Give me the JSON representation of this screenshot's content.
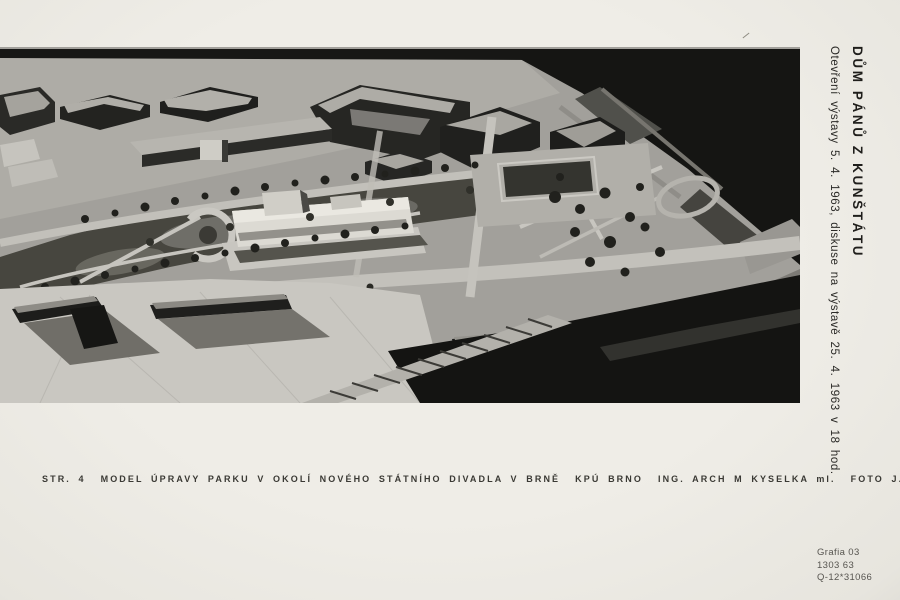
{
  "document": {
    "spine": {
      "title": "DŮM PÁNŮ Z KUNŠTÁTU",
      "subtitle": "Otevření výstavy 5. 4. 1963, diskuse na výstavě 25. 4. 1963 v 18 hod."
    },
    "caption": {
      "page_ref": "STR. 4",
      "title": "MODEL ÚPRAVY PARKU V OKOLÍ NOVÉHO STÁTNÍHO DIVADLA V BRNĚ",
      "office": "KPÚ BRNO",
      "architect": "ING. ARCH M KYSELKA ml.",
      "photographer": "FOTO J. KOPAL"
    },
    "imprint": {
      "line1": "Grafia 03",
      "line2": "1303 63",
      "line3": "Q-12*31066"
    },
    "photo": {
      "description": "Black-and-white oblique aerial photograph of an architectural scale model: park layout around the new state theatre in Brno, with city blocks above, white theatre building at centre, tree-lined roads, empty light model base at lower left and dark photo background at top right and bottom right",
      "colors": {
        "paper": "#edebe5",
        "photo_light_base": "#c9c7c1",
        "photo_mid_ground": "#a2a09b",
        "photo_dark_background": "#151513",
        "theatre_white": "#dcdad3",
        "ink": "#2b2a27"
      }
    }
  }
}
